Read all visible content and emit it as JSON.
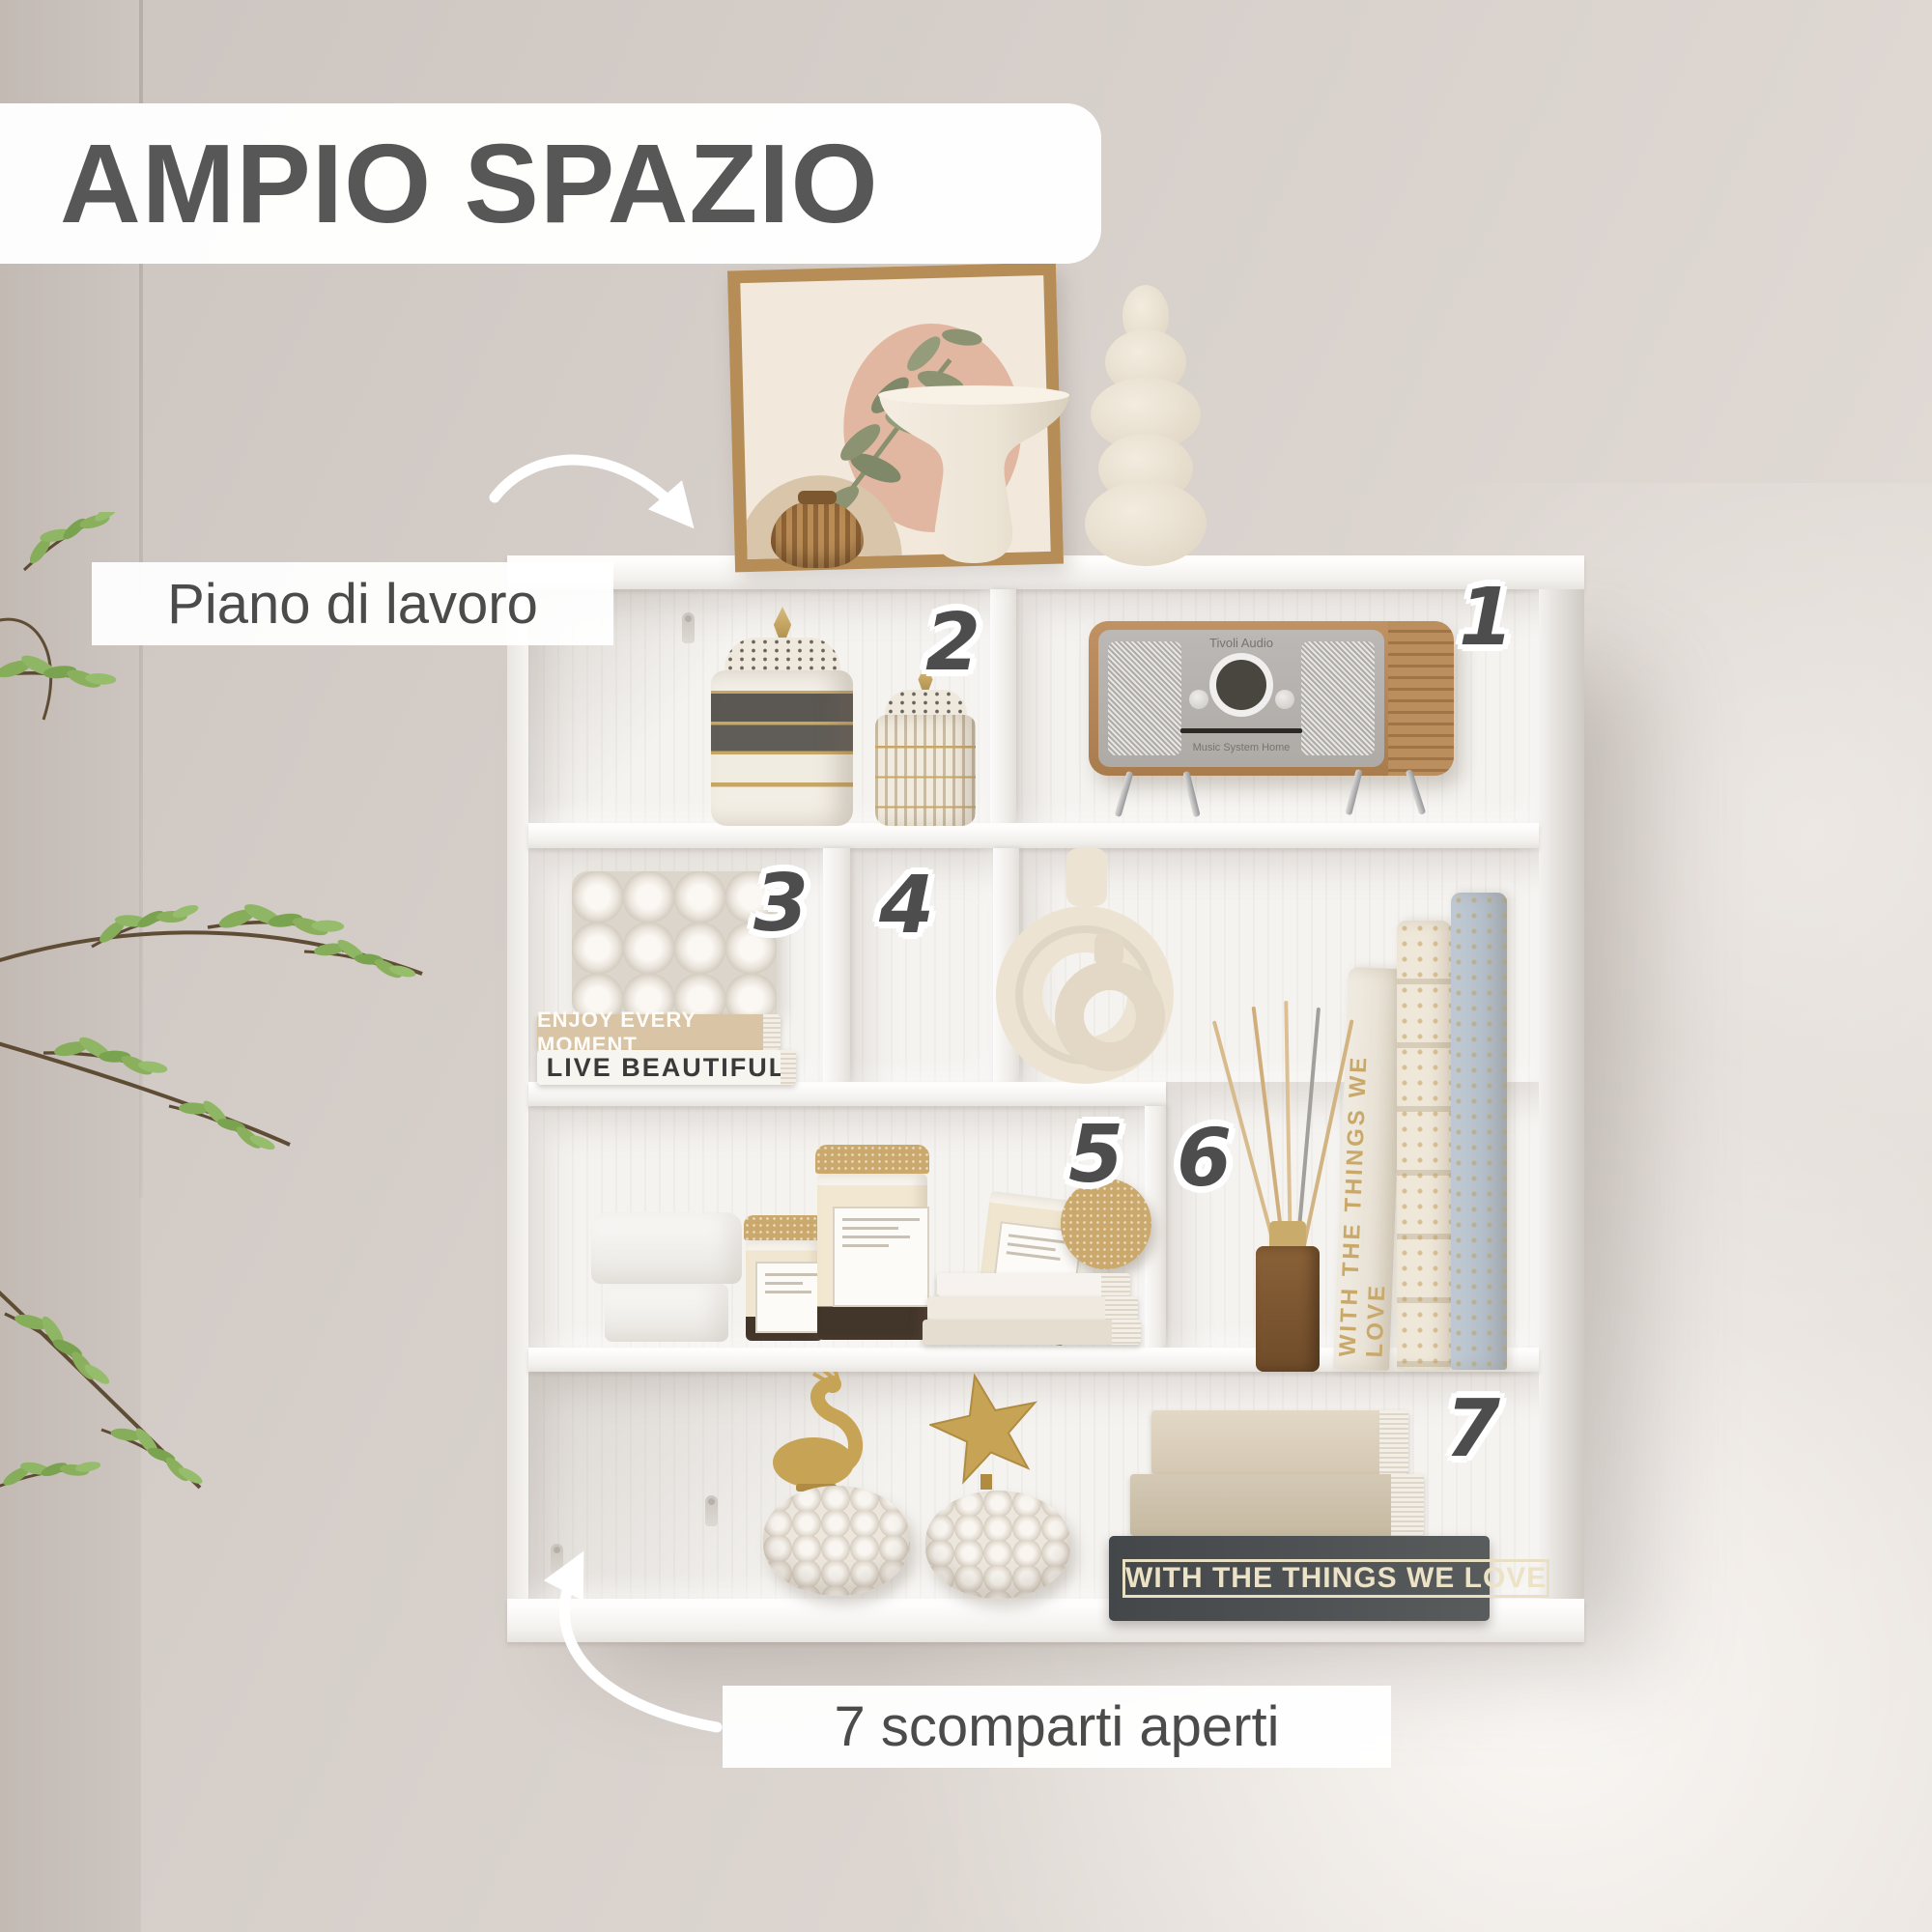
{
  "title": "AMPIO SPAZIO",
  "callouts": {
    "top_label": "Piano di lavoro",
    "bottom_label": "7 scomparti aperti"
  },
  "numbers": [
    "1",
    "2",
    "3",
    "4",
    "5",
    "6",
    "7"
  ],
  "books": {
    "spine_top": "ENJOY EVERY MOMENT",
    "spine_bottom": "LIVE BEAUTIFUL",
    "dark_spine": "WITH THE THINGS WE LOVE",
    "standing_spine": "WITH THE THINGS WE LOVE"
  },
  "radio": {
    "brand": "Tivoli Audio",
    "model": "Music System Home"
  },
  "colors": {
    "title_text": "#575757",
    "number_text": "#4d4d4d",
    "gold_accent": "#c7a455",
    "wood": "#b8885a",
    "wall": "#d5cec9"
  }
}
